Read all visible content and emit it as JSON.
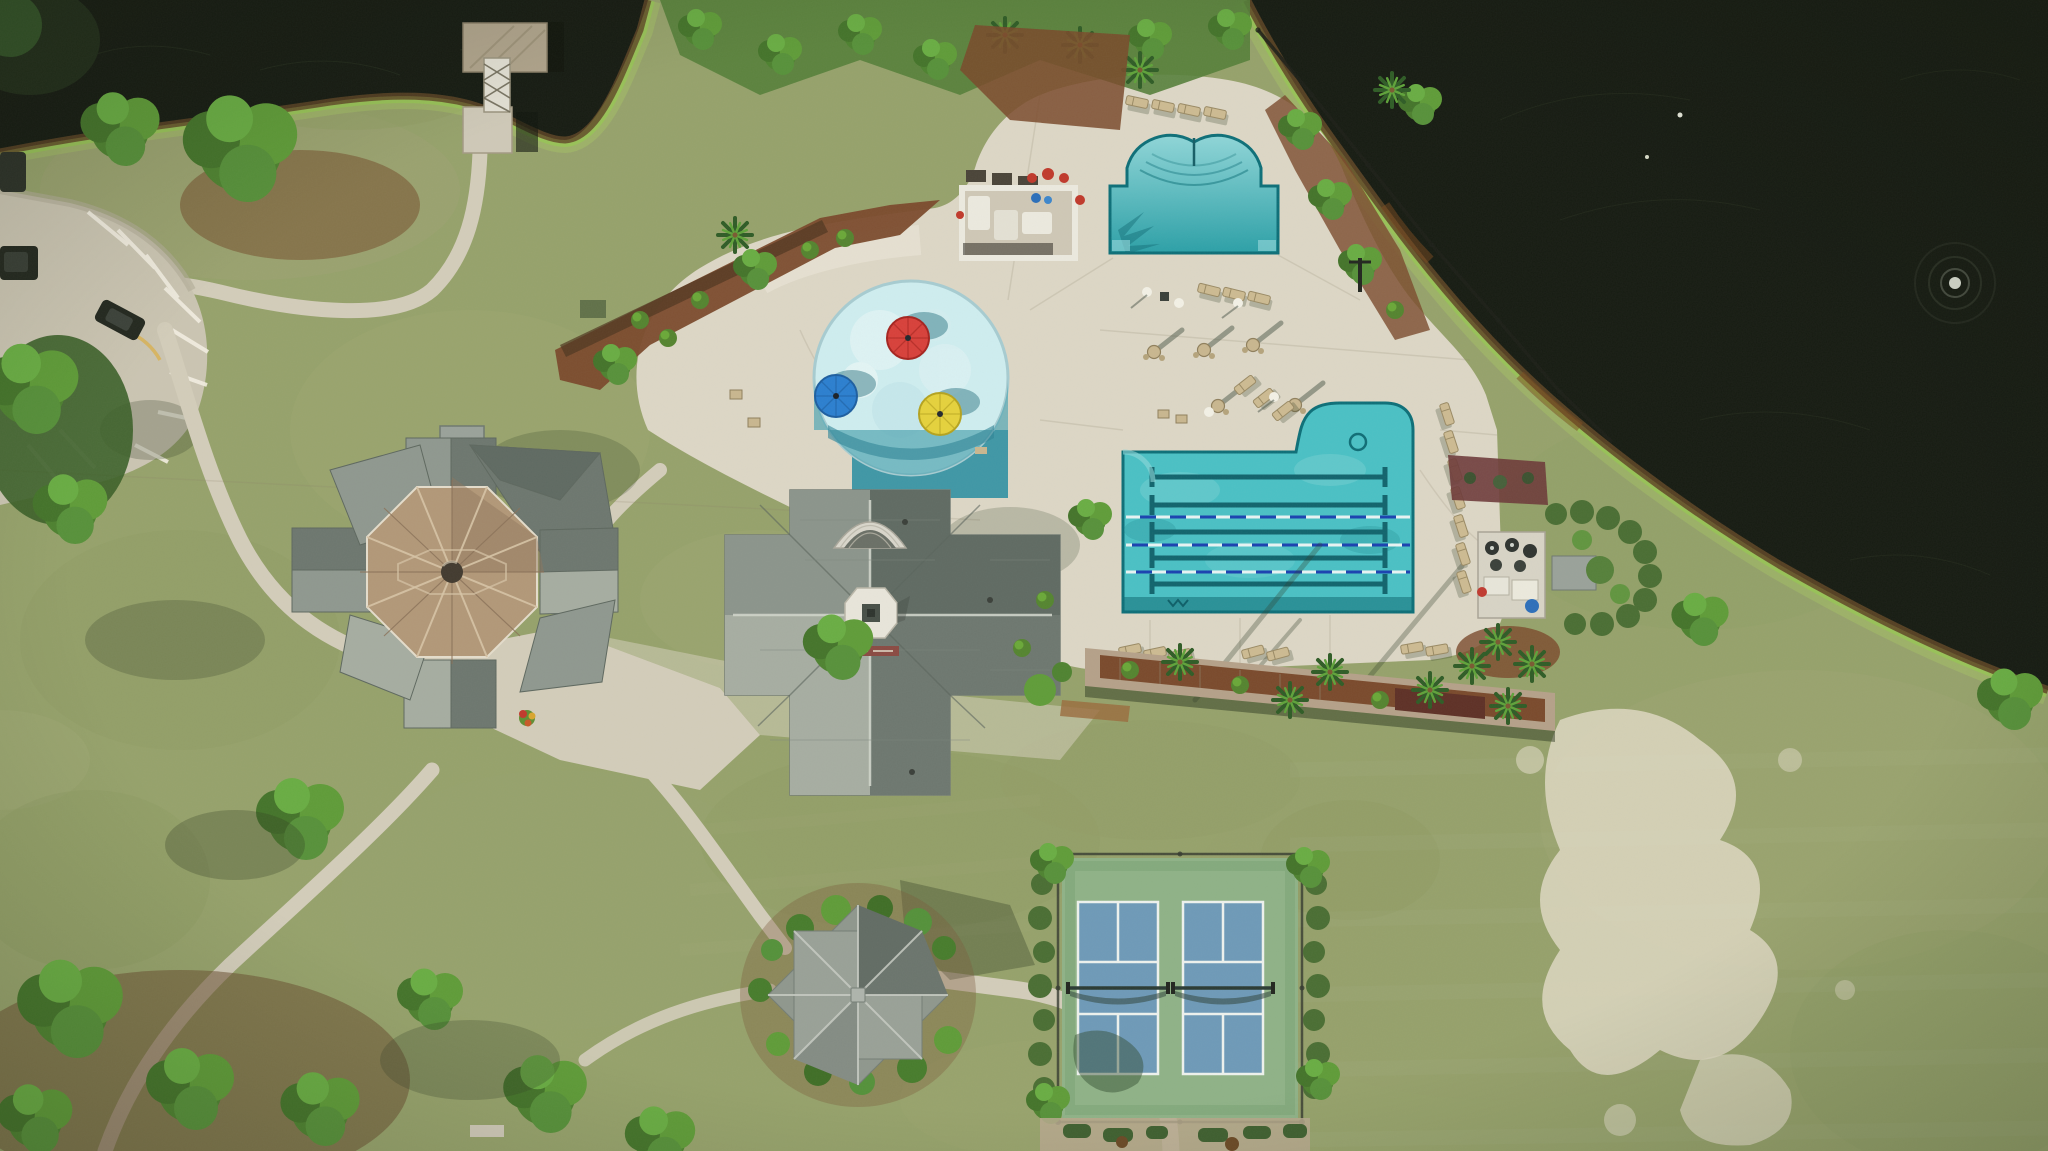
{
  "meta": {
    "title": "Aerial drone view of community amenity center",
    "width": 2048,
    "height": 1151
  },
  "scene": {
    "description": "Overhead aerial photograph of a residential community amenity campus: a gray-roofed clubhouse with white cupola, an octagonal pavilion with tan metal roof, a circular splash pad with red, blue and yellow mushroom umbrellas, an arched leisure pool, an L-shaped lap pool with five painted lane lines and three floating ropes, a cream concrete pool deck with lounge chairs and umbrella tables, a white cabana pergola, a pool equipment pad, two blue pickleball courts on a green sport apron, a star-roofed gazebo, winding concrete walking paths, a striped parking lot with dark vehicles, a covered boat dock, mulch planting beds with palms and shrubs, mottled green lawns with a sandy dead patch, and two dark ponds, the right one with a small fountain.",
    "elements": [
      {
        "name": "lake-top-left",
        "label": "Dark pond, top left"
      },
      {
        "name": "lake-right",
        "label": "Dark pond, right"
      },
      {
        "name": "fountain-splash",
        "label": "Pond fountain"
      },
      {
        "name": "boat-dock",
        "label": "Covered boat dock with gangway"
      },
      {
        "name": "parking-lot",
        "label": "Striped parking lot"
      },
      {
        "name": "vehicle",
        "label": "Parked dark vehicles"
      },
      {
        "name": "octagon-pavilion",
        "label": "Octagonal pavilion, tan metal roof"
      },
      {
        "name": "clubhouse",
        "label": "Clubhouse with cupola"
      },
      {
        "name": "splash-pad",
        "label": "Circular splash pad"
      },
      {
        "name": "umbrella-red",
        "label": "Red mushroom umbrella"
      },
      {
        "name": "umbrella-blue",
        "label": "Blue mushroom umbrella"
      },
      {
        "name": "umbrella-yellow",
        "label": "Yellow mushroom umbrella"
      },
      {
        "name": "leisure-pool",
        "label": "Arched leisure pool"
      },
      {
        "name": "lap-pool",
        "label": "Six-lane lap pool"
      },
      {
        "name": "pool-deck",
        "label": "Concrete pool deck"
      },
      {
        "name": "cabana-pergola",
        "label": "White cabana pergola"
      },
      {
        "name": "equipment-pad",
        "label": "Pool equipment pad"
      },
      {
        "name": "retaining-wall",
        "label": "Retaining wall planter with palms"
      },
      {
        "name": "pickleball-courts",
        "label": "Two pickleball courts"
      },
      {
        "name": "small-pavilion",
        "label": "Star-roofed gazebo"
      },
      {
        "name": "walking-path",
        "label": "Concrete walking paths"
      },
      {
        "name": "sand-patch",
        "label": "Sandy dead grass patch"
      },
      {
        "name": "palm-tree",
        "label": "Palm trees"
      },
      {
        "name": "tree",
        "label": "Shade trees"
      },
      {
        "name": "mulch-bed",
        "label": "Mulch planting beds"
      }
    ],
    "counts": {
      "pickleball_courts": 2,
      "lap_pool_painted_lanes": 5,
      "lap_pool_float_ropes": 3,
      "splash_umbrellas": 3,
      "ponds": 2
    }
  },
  "colors": {
    "grass": "#96a26b",
    "grassLight": "#aab277",
    "grassDry": "#b3b289",
    "grassDark": "#7c8c52",
    "water": "#161b12",
    "waterLight": "#20271a",
    "fringe": "#96c455",
    "shoreBrown": "#5f4526",
    "deck": "#ddd7c6",
    "deckLight": "#e9e4d6",
    "path": "#d3cdba",
    "parking": "#cbc5b2",
    "poolWater": "#4ac1c5",
    "poolDeep": "#2ba0a7",
    "poolEdge": "#0d6f78",
    "laneDark": "#11646d",
    "splash": "#cfeef0",
    "splashShadow": "#58aab6",
    "splashDeep": "#3f97a6",
    "roofGray": "#8f988f",
    "roofGrayMid": "#6d776f",
    "roofGrayDark": "#5f6a62",
    "roofLight": "#a6ada1",
    "roofTan": "#b29878",
    "roofTanDark": "#8f765a",
    "cupola": "#e8e5da",
    "mulch": "#7a4a2c",
    "mulchDark": "#5e3026",
    "courtGreen": "#8fb287",
    "courtBlue": "#6e9ab8",
    "courtLine": "#eef2ee",
    "hedge": "#4a6e33",
    "treeBright": "#6aa83e",
    "treeDark": "#3f6b2e",
    "umbRed": "#d8403a",
    "umbBlue": "#2b7fd0",
    "umbYellow": "#e6d23c",
    "sand": "#ded8c2",
    "shadow": "#2e3a22",
    "carDark": "#23281f",
    "white": "#eceadf"
  }
}
